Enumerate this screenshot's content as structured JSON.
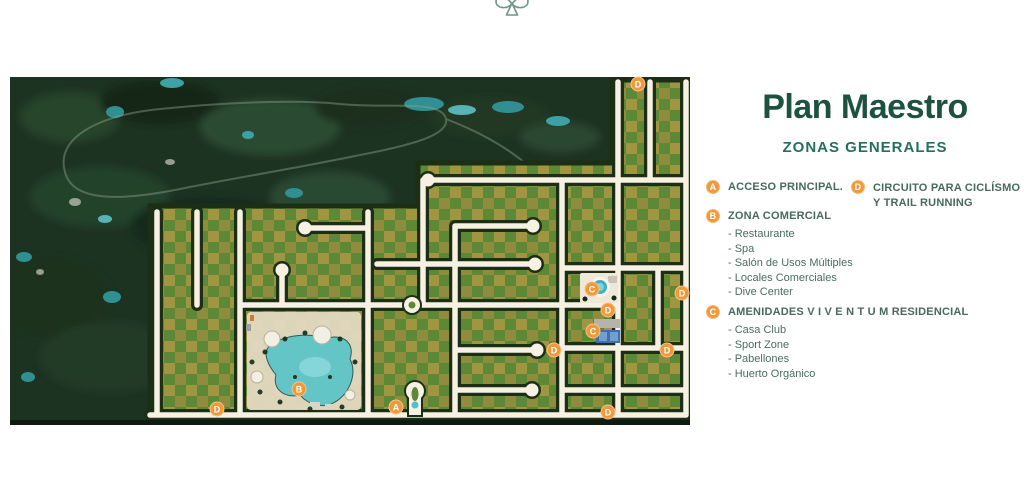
{
  "header": {
    "title": "Plan Maestro",
    "subtitle": "ZONAS GENERALES"
  },
  "legend": {
    "sections": [
      {
        "letter": "A",
        "title": "ACCESO PRINCIPAL.",
        "items": []
      },
      {
        "letter": "B",
        "title": "ZONA COMERCIAL",
        "items": [
          "- Restaurante",
          "- Spa",
          "- Salón de Usos Múltiples",
          "- Locales Comerciales",
          "- Dive Center"
        ]
      },
      {
        "letter": "C",
        "title": "AMENIDADES V I V E N T U M RESIDENCIAL",
        "items": [
          "- Casa Club",
          "- Sport Zone",
          "- Pabellones",
          "- Huerto Orgánico"
        ]
      },
      {
        "letter": "D",
        "title_lines": [
          "CIRCUITO PARA CICLÍSMO",
          "Y TRAIL RUNNING"
        ],
        "items": []
      }
    ]
  },
  "map": {
    "markers": [
      {
        "letter": "D",
        "x": 628,
        "y": 7
      },
      {
        "letter": "D",
        "x": 672,
        "y": 216
      },
      {
        "letter": "C",
        "x": 582,
        "y": 212
      },
      {
        "letter": "D",
        "x": 598,
        "y": 233
      },
      {
        "letter": "C",
        "x": 583,
        "y": 254
      },
      {
        "letter": "D",
        "x": 544,
        "y": 273
      },
      {
        "letter": "D",
        "x": 657,
        "y": 273
      },
      {
        "letter": "B",
        "x": 289,
        "y": 312
      },
      {
        "letter": "A",
        "x": 386,
        "y": 330
      },
      {
        "letter": "D",
        "x": 207,
        "y": 332
      },
      {
        "letter": "D",
        "x": 598,
        "y": 335
      }
    ]
  },
  "colors": {
    "accent_orange": "#f0993a",
    "title_green": "#1d5240",
    "subtitle_green": "#23715c",
    "legend_text": "#47695e",
    "road_cream": "#f7f1e4",
    "lot_olive": "#a09540",
    "lot_green": "#5d8836",
    "jungle_dark": "#1d3322",
    "water_teal": "#2f8f92"
  }
}
